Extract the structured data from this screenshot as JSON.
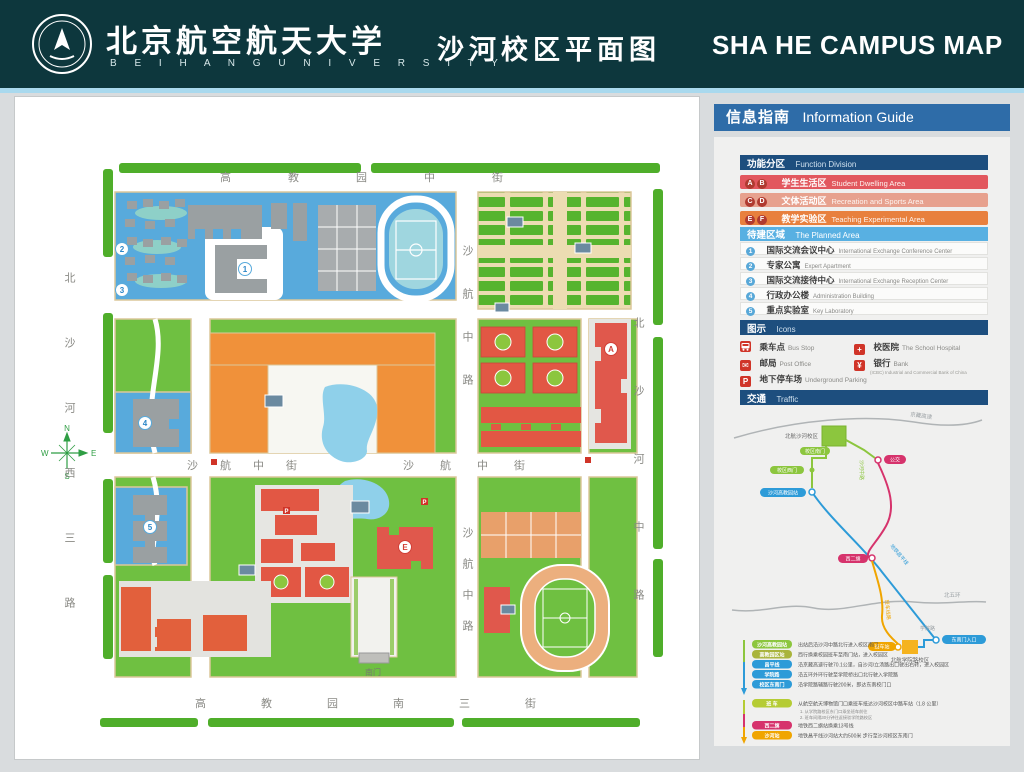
{
  "header": {
    "university_cn": "北京航空航天大学",
    "university_en": "B E I H A N G   U N I V E R S I T Y",
    "title_cn": "沙河校区平面图",
    "title_en": "SHA HE  CAMPUS MAP"
  },
  "map": {
    "streets": {
      "top": "高教园中街",
      "bottom": "高教园南三街",
      "left": "北沙河西三路",
      "right": "北沙河中路",
      "mid_west": "沙航中街",
      "mid_east": "沙航中街",
      "v_upper": "沙航中路",
      "v_lower": "沙航中路"
    },
    "gates": {
      "south": "南门"
    },
    "compass": {
      "n": "N",
      "e": "E",
      "s": "S",
      "w": "W"
    },
    "badges": {
      "n1": "1",
      "n2": "2",
      "n3": "3",
      "n4": "4",
      "n5": "5",
      "a": "A",
      "e": "E"
    }
  },
  "guide": {
    "header_cn": "信息指南",
    "header_en": "Information Guide",
    "function": {
      "cn": "功能分区",
      "en": "Function Division"
    },
    "zones": [
      {
        "badges": [
          "A",
          "B"
        ],
        "cn": "学生生活区",
        "en": "Student Dwelling Area",
        "color": "#e2575e"
      },
      {
        "badges": [
          "C",
          "D"
        ],
        "cn": "文体活动区",
        "en": "Recreation and Sports Area",
        "color": "#e7a18e"
      },
      {
        "badges": [
          "E",
          "F"
        ],
        "cn": "教学实验区",
        "en": "Teaching Experimental Area",
        "color": "#e8803e"
      }
    ],
    "planned": {
      "cn": "待建区域",
      "en": "The Planned Area",
      "color": "#58b0e2"
    },
    "planned_items": [
      {
        "num": "1",
        "cn": "国际交流会议中心",
        "en": "International Exchange Conference Center"
      },
      {
        "num": "2",
        "cn": "专家公寓",
        "en": "Expert Apartment"
      },
      {
        "num": "3",
        "cn": "国际交流接待中心",
        "en": "International Exchange Reception Center"
      },
      {
        "num": "4",
        "cn": "行政办公楼",
        "en": "Administration Building"
      },
      {
        "num": "5",
        "cn": "重点实验室",
        "en": "Key Laboratory"
      }
    ],
    "icons_header": {
      "cn": "图示",
      "en": "Icons"
    },
    "icon_items": [
      {
        "glyph": "bus",
        "cn": "乘车点",
        "en": "Bus Stop"
      },
      {
        "glyph": "cross",
        "cn": "校医院",
        "en": "The School Hospital"
      },
      {
        "glyph": "post",
        "cn": "邮局",
        "en": "Post Office"
      },
      {
        "glyph": "bank",
        "cn": "银行",
        "en": "Bank",
        "sub": "(ICBC) Industrial and Commercial Bank of China"
      },
      {
        "glyph": "parking",
        "cn": "地下停车场",
        "en": "Underground Parking"
      }
    ],
    "traffic_header": {
      "cn": "交通",
      "en": "Traffic"
    }
  },
  "traffic": {
    "roads": {
      "highway": "京藏高速",
      "ring": "北五环",
      "branch": "学院路"
    },
    "campus_main": "北航沙河校区",
    "campus_south": "北航学院路校区",
    "line_labels": {
      "walk": "沙河中路",
      "subway": "地铁昌平线",
      "shuttle": "班车线路"
    },
    "stations": {
      "south_gate": "校区南门",
      "west_gate": "校区西门",
      "subway_shahe": "沙河高教园站",
      "bus": "公交",
      "xierqi": "西二旗",
      "shuttle_stop": "班车站",
      "se_gate": "东南门入口"
    },
    "legend": [
      {
        "label": "沙河高教园站",
        "color": "#8cc63e",
        "text": "出站后沿沙河中路北行进入校区南门"
      },
      {
        "label": "高教园区站",
        "color": "#a9b43b",
        "text": "西行换乘校园班车至南门站，进入校园区"
      },
      {
        "label": "昌平线",
        "color": "#2d9bd8",
        "text": "沿京藏高速行驶70.1公里，自沙河/立汤路出口驶出右转，进入校园区"
      },
      {
        "label": "学院路",
        "color": "#2d9bd8",
        "text": "沿五环外环行驶至学院桥出口北行驶入学院路"
      },
      {
        "label": "校区东南门",
        "color": "#2d9bd8",
        "text": "沿学院路辅路行驶200米，即达东南校门口"
      },
      {
        "label": "班  车",
        "color": "#b5cc34",
        "text": "从航空航天博物馆门口乘班车抵达沙河校区中路车站（1.8 公里）",
        "sub1": "1. 从学院路校区东门口乘坐班车前往",
        "sub2": "2. 班车间隔30分钟往返接驳学院路校区"
      },
      {
        "label": "西二旗",
        "color": "#d6336c",
        "text": "地铁西二旗站换乘13号线"
      },
      {
        "label": "沙河站",
        "color": "#f0a500",
        "text": "地铁昌平线沙河站大约500米 步行至沙河校区东南门"
      }
    ]
  },
  "colors": {
    "header_bg": "#0d373d",
    "divider": "#a9d9ee",
    "page_bg": "#d9dcde",
    "guide_header_bg": "#2e6ca8",
    "section_bar_bg": "#1d4e7e",
    "campus_green": "#6fc041",
    "planned_blue": "#58aadc",
    "teaching_orange": "#f0913a",
    "dorm_red": "#e25744",
    "pond_blue": "#8fd0ea",
    "icon_red": "#d03428"
  }
}
